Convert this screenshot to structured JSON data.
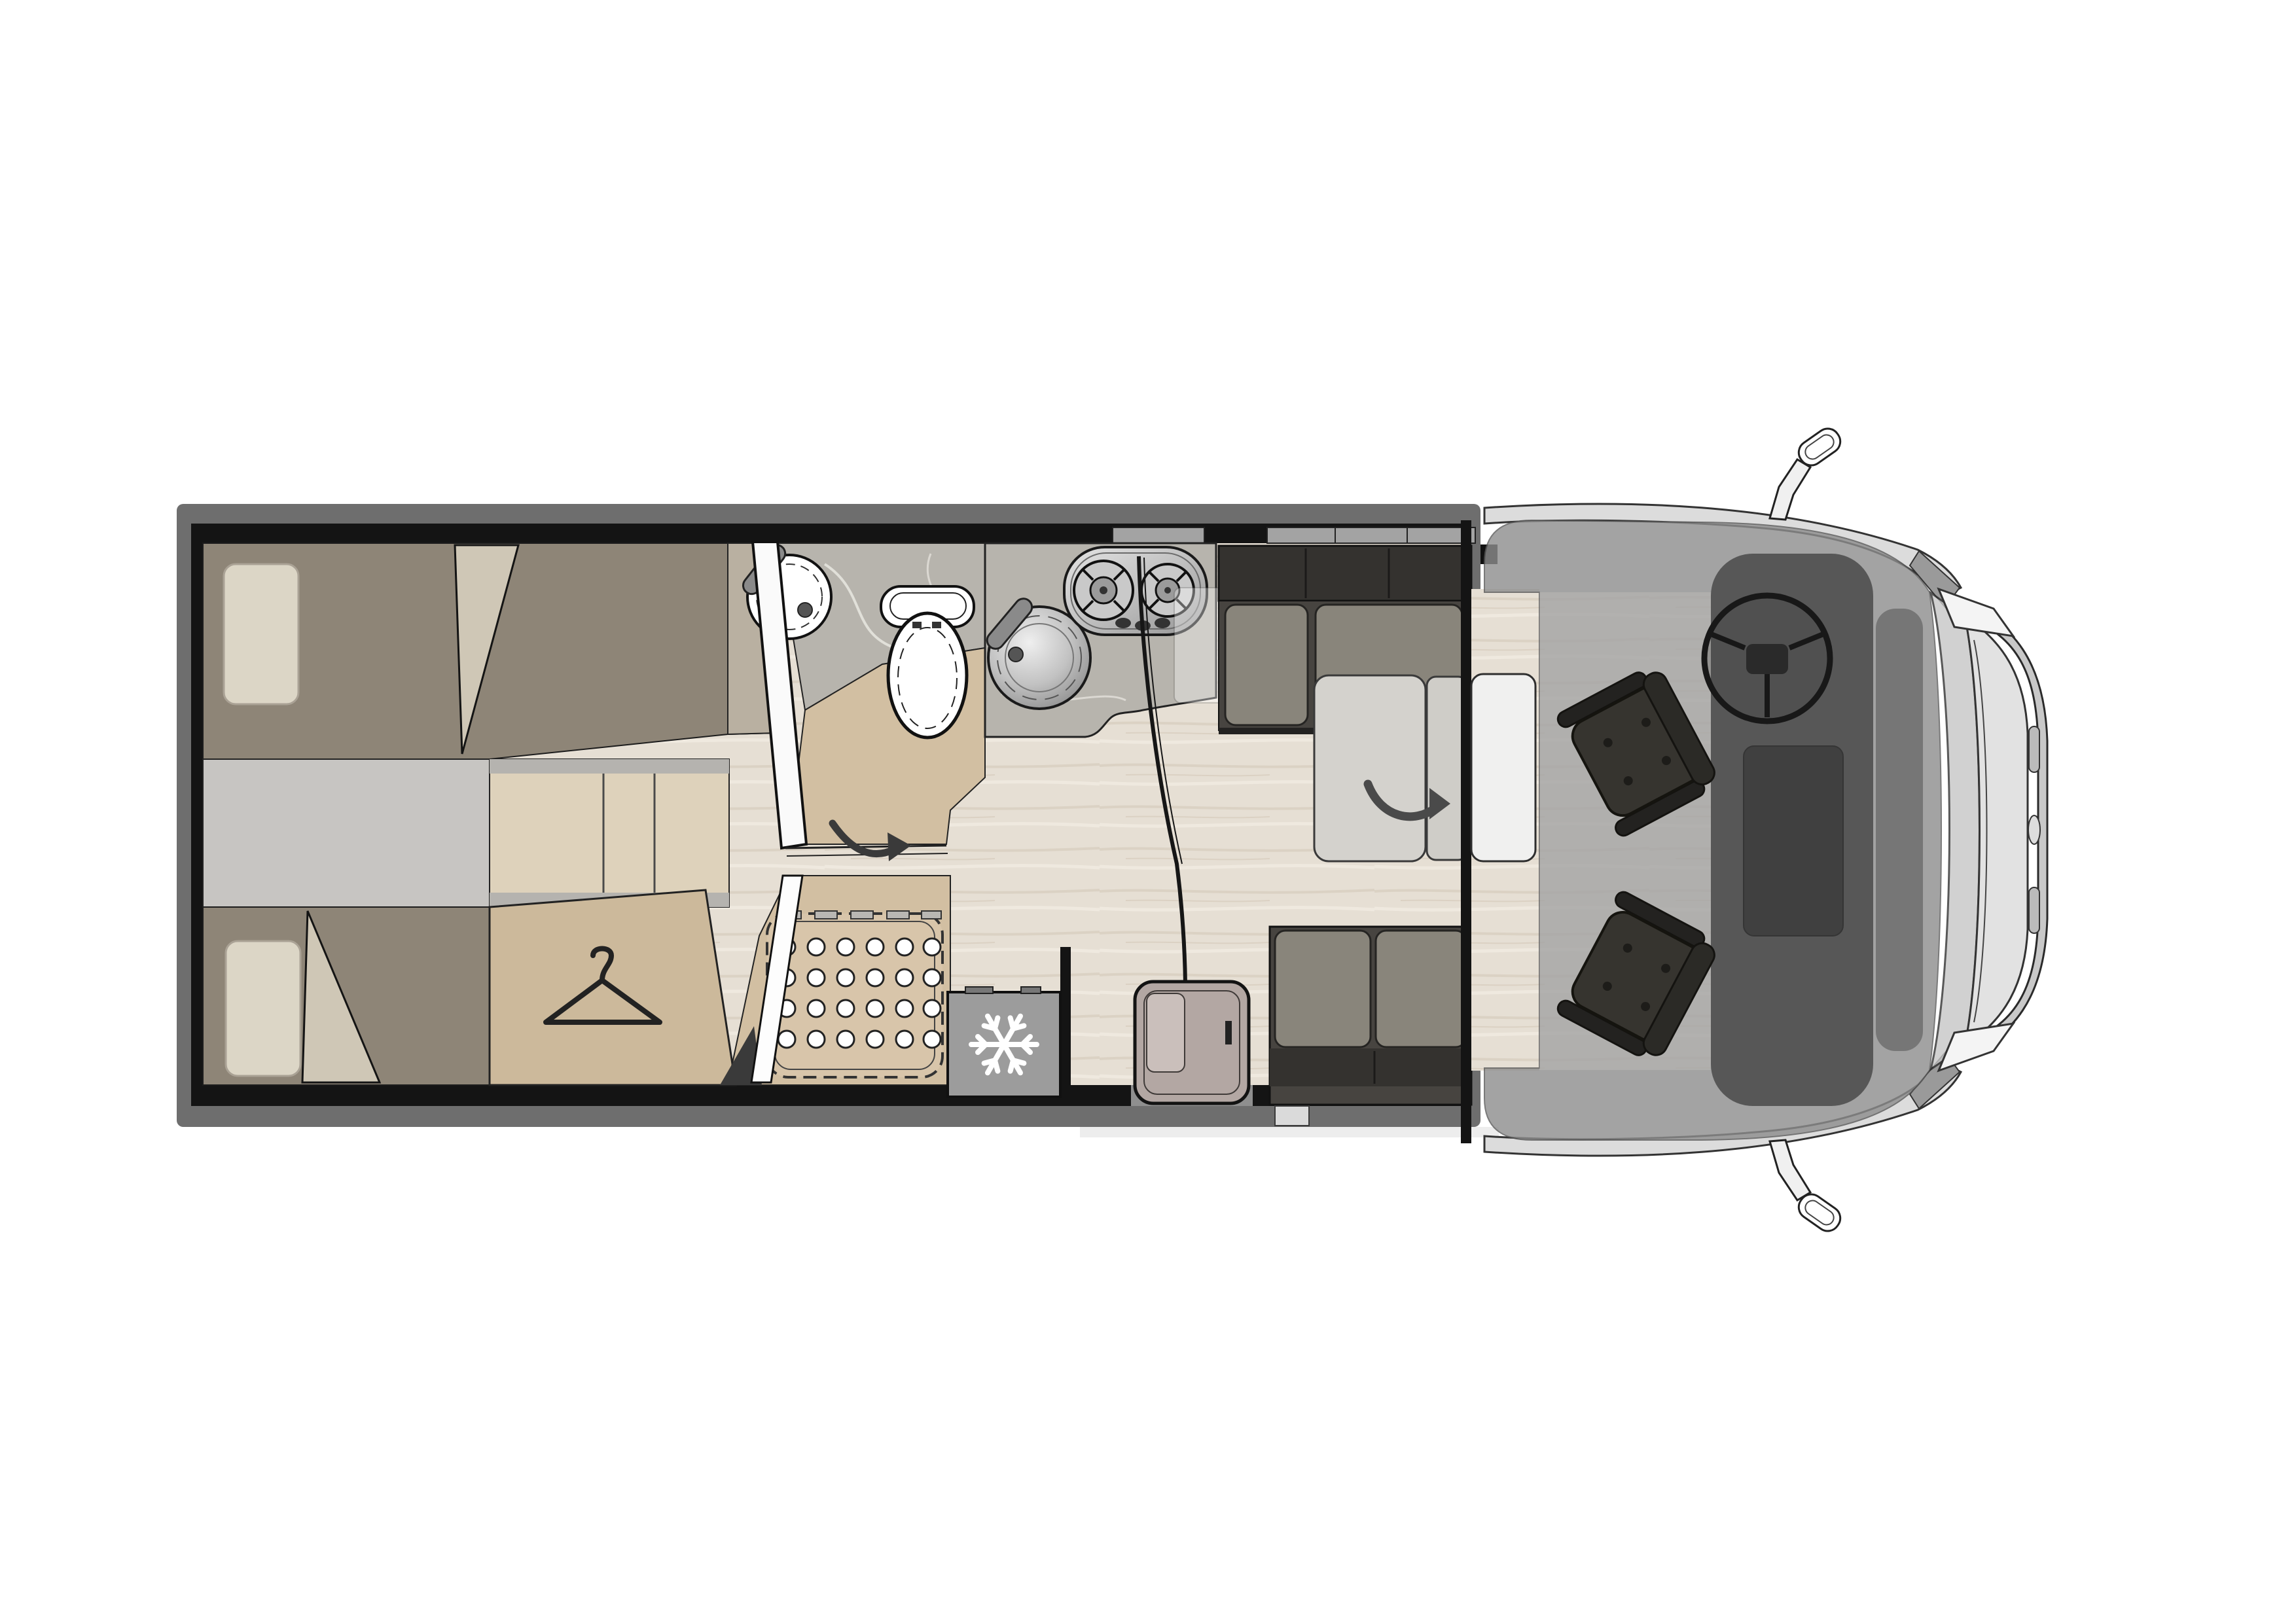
{
  "plan": {
    "kind": "motorhome-floorplan-top-view",
    "orientation": "cab-at-right",
    "rooms": [
      {
        "id": "rear-bedroom",
        "label": "twin single beds"
      },
      {
        "id": "washroom",
        "label": "washbasin and toilet"
      },
      {
        "id": "shower",
        "label": "shower tray"
      },
      {
        "id": "wardrobe",
        "label": "wardrobe"
      },
      {
        "id": "kitchen",
        "label": "sink and two-burner hob"
      },
      {
        "id": "dinette",
        "label": "benches with folding table"
      },
      {
        "id": "cab",
        "label": "driver cab with swivel seats"
      }
    ]
  },
  "icons": {
    "snowflake": "fridge-freezer marker",
    "hanger": "wardrobe marker",
    "fold-arrow": "table fold direction",
    "swing-arrow": "door swing direction"
  },
  "colors": {
    "white": "#ffffff",
    "line": "#161616",
    "wall": "#141414",
    "band": "#6e6e6e",
    "floor_wood": "#e6dfd4",
    "floor_grain": "#d9d0c2",
    "bed": "#8e8577",
    "bed_wedge": "#b9b0a1",
    "pillow": "#dcd6c6",
    "blanket": "#cfc7b6",
    "aisle": "#c7c5c2",
    "steps_wood": "#ded2bb",
    "steps_trim": "#b5b3af",
    "wardrobe": "#ccb99b",
    "bath_floor": "#d2bfa2",
    "marble": "#b7b4ad",
    "marble_vein": "#e9e7e1",
    "shower_tray": "#d8c5aa",
    "shower_hole": "#ffffff",
    "fridge": "#9c9c9c",
    "snowflake": "#ffffff",
    "bench": "#474440",
    "bench_back": "#34322f",
    "cushion": "#8f8b80",
    "table": "#d4d2cd",
    "table_fold": "#cfcdc8",
    "table_ext": "#f0f0ef",
    "door_panel": "#b3a7a3",
    "door_window": "#cabfbb",
    "entry_step": "#dadada",
    "overlay": "#8d8d8d",
    "cab_interior": "#343434",
    "dash": "#4a4a4a",
    "windshield": "#c6c6c6",
    "hood": "#e2e2e2",
    "bumper": "#c8c8c8",
    "headlight": "#f4f4f4",
    "body_side": "#dcdcdc",
    "pillar": "#9a9a9a",
    "seat": "#36342f",
    "seat_back": "#2b2a26",
    "seat_arm": "#232220",
    "arrow": "#4a4a4a",
    "basin": "#ffffff",
    "toilet": "#ffffff",
    "faucet": "#8a8a8a",
    "mirror_body": "#f0f0f0"
  }
}
